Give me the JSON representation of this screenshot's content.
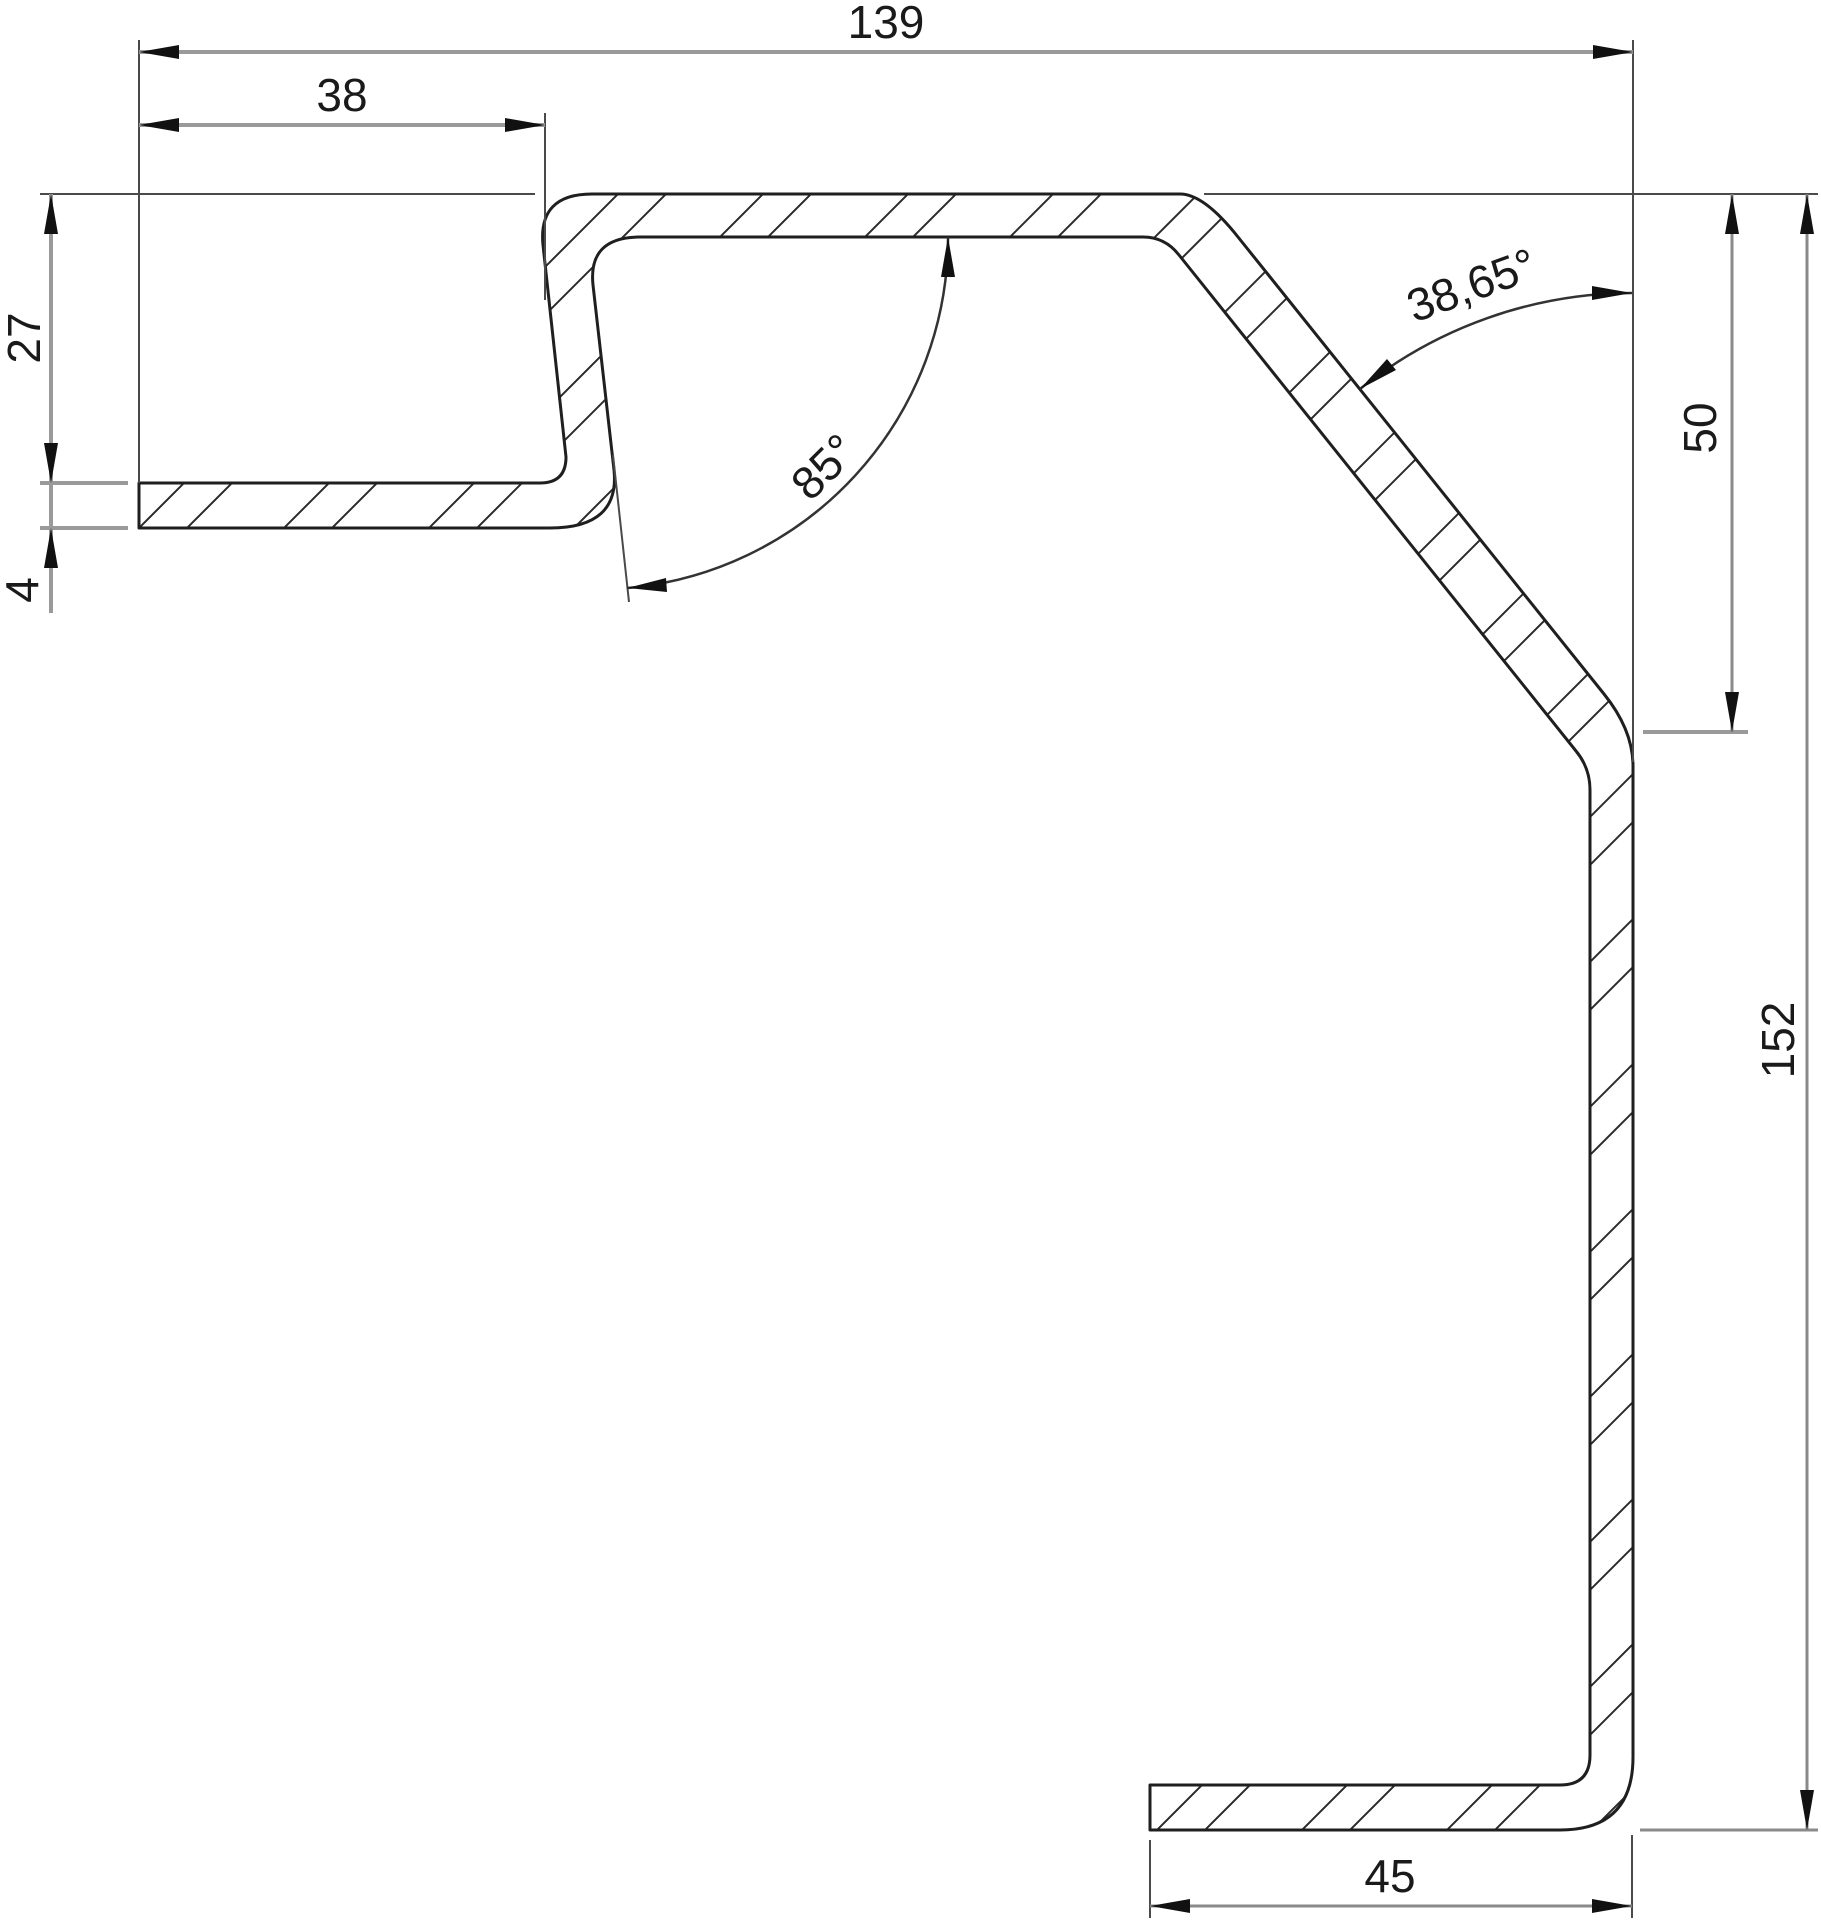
{
  "drawing": {
    "type": "technical-section-profile",
    "colors": {
      "background": "#ffffff",
      "profile_line": "#1f1f1f",
      "dimension_line": "#9a9a9a",
      "text": "#1a1a1a"
    },
    "dimensions": {
      "total_width": "139",
      "upper_flange_width": "38",
      "left_height": "27",
      "sheet_thickness": "4",
      "s_bend_angle": "85°",
      "bevel_angle": "38,65°",
      "bevel_drop_height": "50",
      "total_height": "152",
      "bottom_flange_width": "45"
    }
  }
}
